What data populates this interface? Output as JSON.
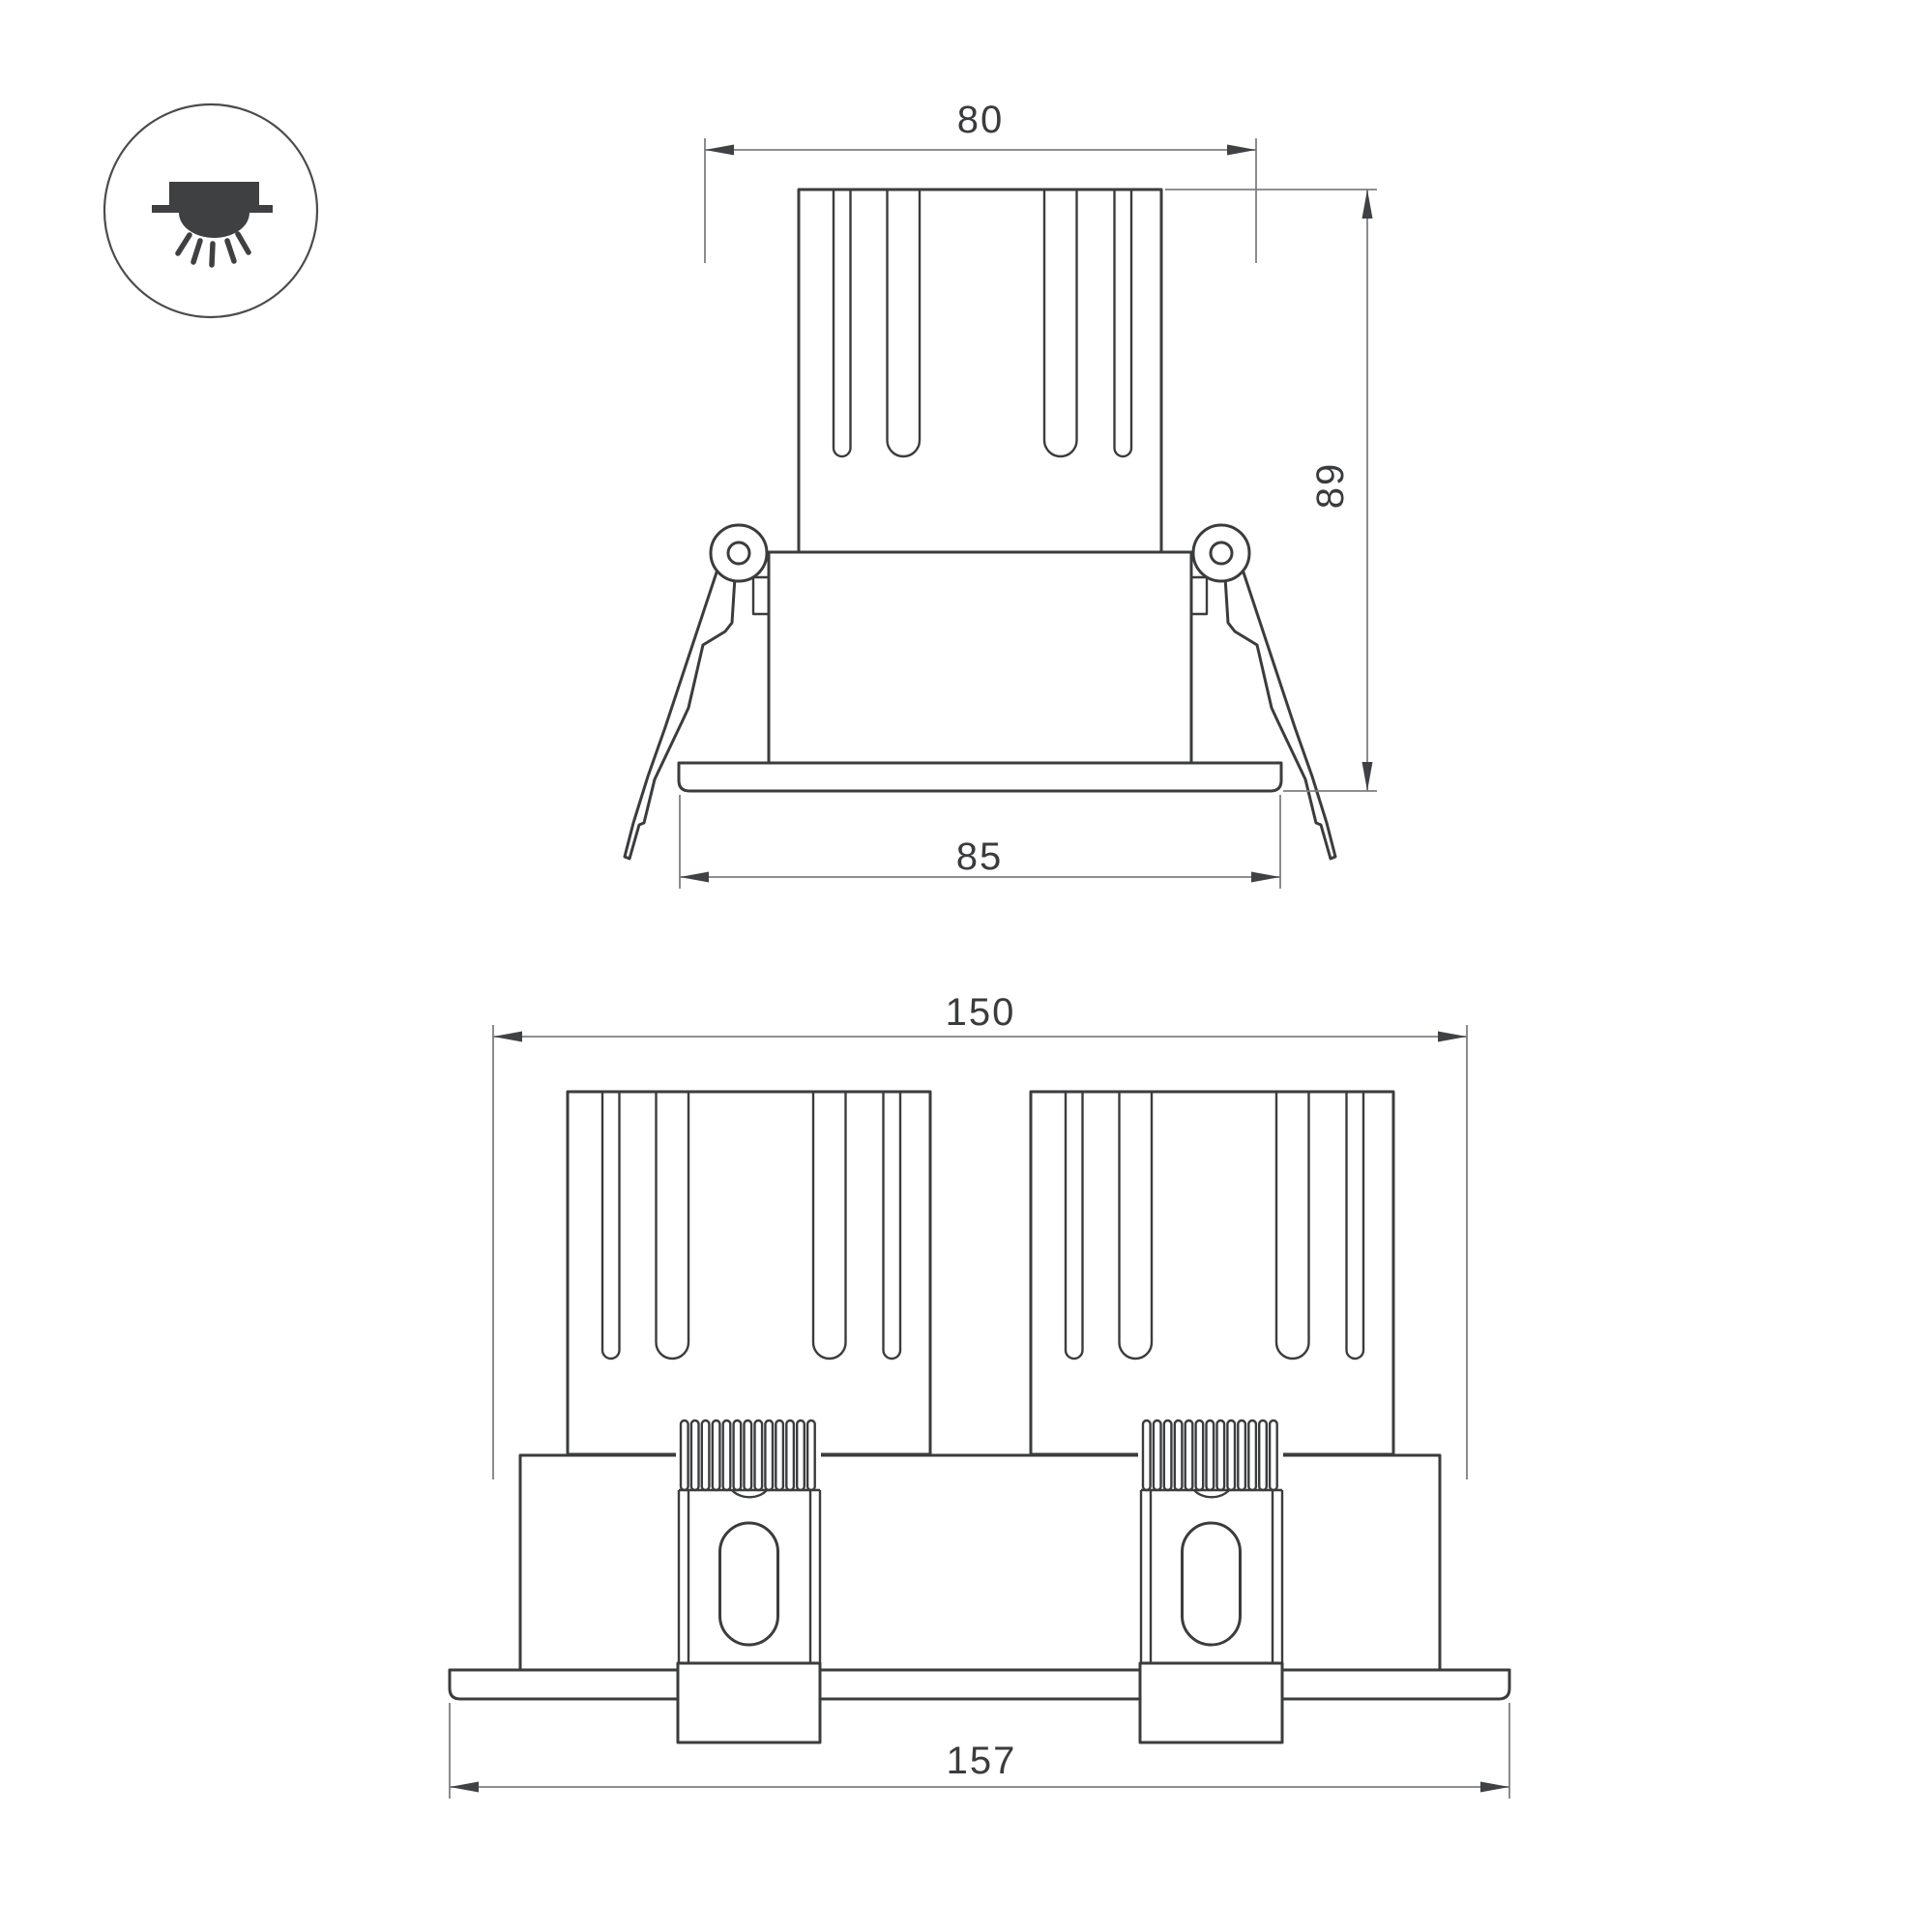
{
  "icon": {
    "name": "recessed-downlight-ceiling-icon"
  },
  "colors": {
    "outline": "#3b3c3e",
    "dimension_lines": "#7d7f82",
    "arrowheads": "#3f4144",
    "text": "#3a3b3d",
    "background": "#ffffff"
  },
  "views": {
    "single": {
      "label": "single-module-front-view",
      "dimensions": {
        "top_width": "80",
        "overall_height": "89",
        "flange_width": "85"
      }
    },
    "double": {
      "label": "twin-module-front-view",
      "dimensions": {
        "overall_width": "150",
        "flange_width": "157"
      }
    }
  }
}
